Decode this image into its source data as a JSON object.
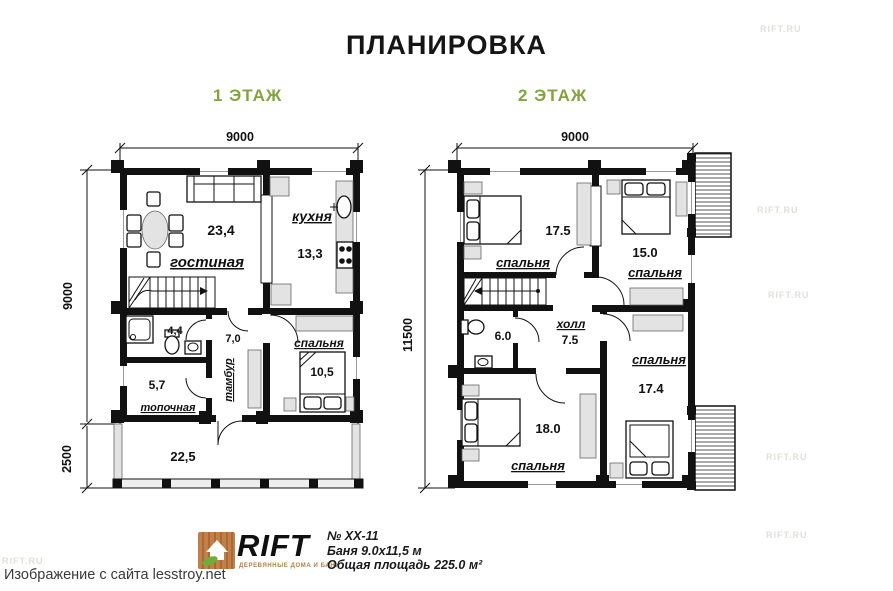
{
  "title": "ПЛАНИРОВКА",
  "floor1": {
    "header": "1 ЭТАЖ",
    "dim_top": "9000",
    "dim_left": "9000",
    "dim_terrace": "2500",
    "living": {
      "name": "гостиная",
      "area": "23,4"
    },
    "kitchen": {
      "name": "кухня",
      "area": "13,3"
    },
    "bath": {
      "area": "4,4"
    },
    "tambour": {
      "name": "тамбур",
      "area": "7,0"
    },
    "bedroom": {
      "name": "спальня",
      "area": "10,5"
    },
    "boiler": {
      "name": "топочная",
      "area": "5,7"
    },
    "terrace": {
      "area": "22,5"
    }
  },
  "floor2": {
    "header": "2 ЭТАЖ",
    "dim_top": "9000",
    "dim_left": "11500",
    "bedroom1": {
      "name": "спальня",
      "area": "17.5"
    },
    "bedroom2": {
      "name": "спальня",
      "area": "15.0"
    },
    "bath": {
      "area": "6.0"
    },
    "hall": {
      "name": "холл",
      "area": "7.5"
    },
    "bedroom3": {
      "name": "спальня",
      "area": "17.4"
    },
    "bedroom4": {
      "name": "спальня",
      "area": "18.0"
    }
  },
  "footer": {
    "brand": "RIFT",
    "brand_sub": "ДЕРЕВЯННЫЕ ДОМА И БАНИ",
    "project_no": "№ ХХ-11",
    "building": "Баня 9.0х11,5 м",
    "total_area": "Общая площадь 225.0 м²"
  },
  "caption": "Изображение с сайта lesstroy.net",
  "watermark": "RIFT.RU"
}
